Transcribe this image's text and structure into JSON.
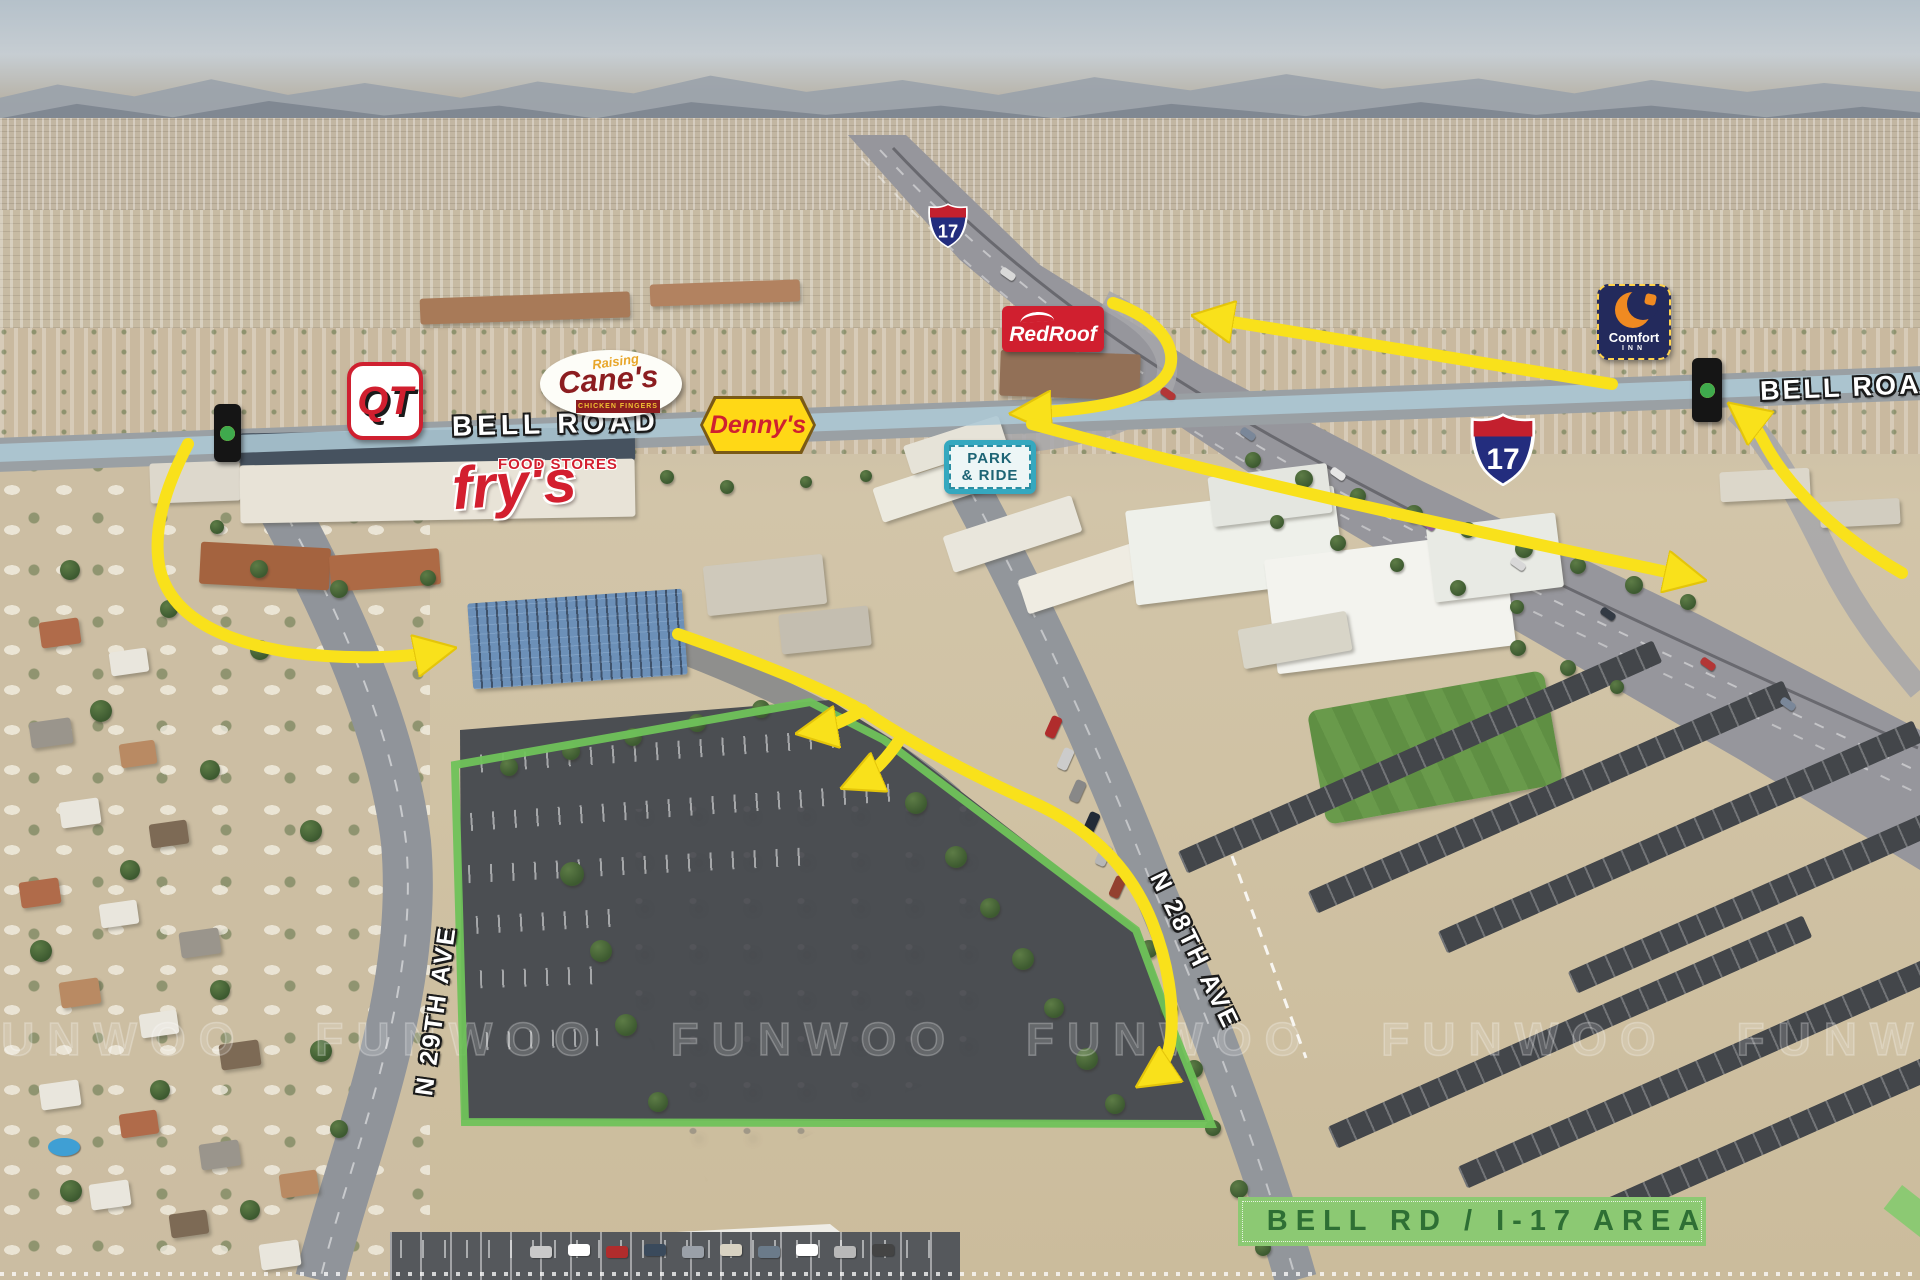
{
  "annotations": {
    "bell_road_label_left": "BELL ROAD",
    "bell_road_label_right": "BELL ROAD",
    "street_29th": "N 29TH AVE",
    "street_28th": "N 28TH AVE",
    "area_banner": "BELL RD / I-17 AREA",
    "interstate_number": "17"
  },
  "signs": {
    "qt": "QT",
    "canes_top": "Raising",
    "canes_main": "Cane's",
    "canes_sub": "CHICKEN FINGERS",
    "dennys": "Denny's",
    "redroof": "RedRoof",
    "comfort_main": "Comfort",
    "comfort_sub": "INN",
    "frys_top": "FOOD STORES",
    "frys_main": "fry's",
    "park_ride_line1": "PARK",
    "park_ride_line2": "& RIDE"
  },
  "watermark": {
    "row": "FUNWOO FUNWOO FUNWOO FUNWOO FUNWOO FUNWOO FUNWOO FUNWOO"
  },
  "colors": {
    "route_arrow": "#f9e11b",
    "property_boundary": "#6fc25a",
    "bell_road_band": "#adc8d5",
    "banner_bg": "#8cc973",
    "banner_text": "#2e6f34"
  }
}
